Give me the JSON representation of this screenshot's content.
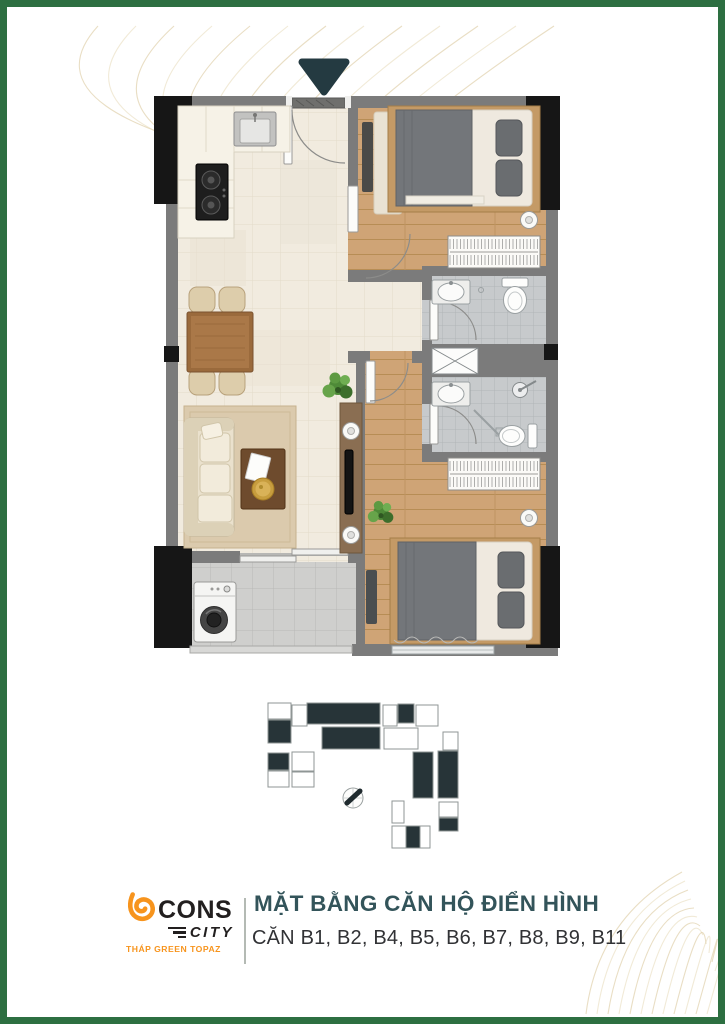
{
  "page": {
    "border_color": "#2d6f41",
    "background": "#ffffff",
    "decor_line_color": "#d7c294"
  },
  "floorplan": {
    "entrance_marker_color": "#243a41",
    "colors": {
      "wall": "#7b7b7b",
      "column": "#161616",
      "wood_floor": "#cfa476",
      "tile_floor": "#f1ebdf",
      "bath_floor": "#c7cacc",
      "balcony_floor": "#cfcfcd",
      "rug": "#dbcaad",
      "tv_wall": "#8a6e52"
    },
    "elements": [
      "entrance-arrow",
      "entrance-door",
      "kitchen-counter",
      "kitchen-sink",
      "cooktop",
      "dining-table",
      "dining-chairs",
      "plant",
      "sofa",
      "rug",
      "coffee-table",
      "tv-wall",
      "tv",
      "wall-lamp",
      "bedroom-1-bed",
      "bedroom-1-wardrobe",
      "bathroom-1-vanity",
      "bathroom-1-toilet",
      "service-shaft",
      "bathroom-2-vanity",
      "bathroom-2-shower",
      "bathroom-2-toilet",
      "bedroom-2-bed",
      "bedroom-2-wardrobe",
      "washing-machine",
      "balcony-railing",
      "window",
      "sliding-door"
    ]
  },
  "keyplan": {
    "outline_color": "#8f9695",
    "fill_dark": "#273438",
    "fill_light": "#ffffff",
    "compass": "compass-icon",
    "blocks": [
      [
        28,
        8,
        23,
        16,
        0
      ],
      [
        52,
        10,
        15,
        21,
        0
      ],
      [
        67,
        8,
        73,
        21,
        1
      ],
      [
        28,
        25,
        23,
        23,
        1
      ],
      [
        82,
        32,
        58,
        22,
        1
      ],
      [
        143,
        10,
        14,
        21,
        0
      ],
      [
        158,
        9,
        16,
        19,
        1
      ],
      [
        176,
        10,
        22,
        21,
        0
      ],
      [
        144,
        33,
        34,
        21,
        0
      ],
      [
        203,
        37,
        15,
        18,
        0
      ],
      [
        28,
        58,
        21,
        17,
        1
      ],
      [
        28,
        76,
        21,
        16,
        0
      ],
      [
        52,
        57,
        22,
        19,
        0
      ],
      [
        52,
        77,
        22,
        15,
        0
      ],
      [
        173,
        57,
        20,
        46,
        1
      ],
      [
        198,
        56,
        20,
        47,
        1
      ],
      [
        152,
        106,
        12,
        22,
        0
      ],
      [
        199,
        107,
        19,
        15,
        0
      ],
      [
        199,
        123,
        19,
        13,
        1
      ],
      [
        152,
        131,
        38,
        22,
        0
      ],
      [
        166,
        131,
        14,
        22,
        1
      ]
    ]
  },
  "footer": {
    "logo": {
      "cons": "CONS",
      "city": "CITY",
      "tagline": "THÁP GREEN TOPAZ",
      "orange": "#f7941d",
      "dark": "#221f1f"
    },
    "title": "MẶT BẰNG CĂN HỘ ĐIỂN HÌNH",
    "title_color": "#33545a",
    "subtitle": "CĂN B1, B2, B4, B5, B6, B7, B8, B9, B11",
    "subtitle_color": "#313235"
  }
}
